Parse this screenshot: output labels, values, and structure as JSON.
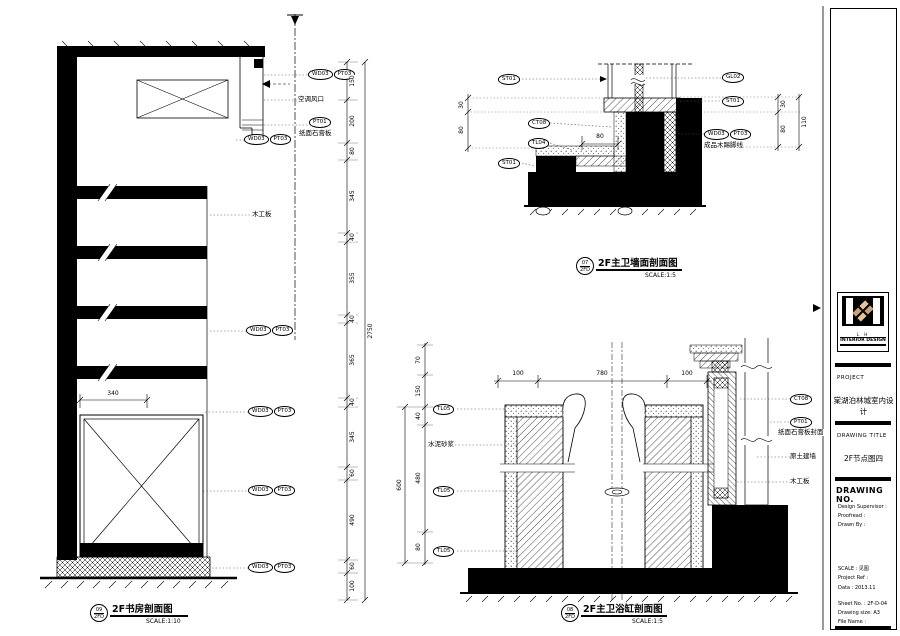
{
  "sheet": {
    "background": "#ffffff",
    "ink": "#000000",
    "wood_accent": "#c8a179",
    "wood_accent_light": "#e2c49e"
  },
  "codes": {
    "wd03": "WD03",
    "pt03": "PT03",
    "pt01": "PT01",
    "st01": "ST01",
    "gl02": "GL02",
    "ct08": "CT08",
    "tl04": "TL04",
    "tl05": "TL05"
  },
  "notes": {
    "ac_vent": "空调风口",
    "gypsum_board": "纸面石膏板",
    "wood_board": "木工板",
    "wood_skirting": "成品木踢脚线",
    "cement_mortar": "水泥砂浆",
    "gypsum_cover": "纸面石膏板封面",
    "original_wall": "原土建墙"
  },
  "drawings": {
    "study": {
      "bubble": {
        "no": "09",
        "sheet": "2FD"
      },
      "title": "2F书房剖面图",
      "scale": "SCALE:1:10",
      "dims": {
        "width": "340",
        "right": [
          "150",
          "200",
          "80",
          "345",
          "40",
          "355",
          "40",
          "365",
          "40",
          "345",
          "60",
          "490",
          "60",
          "100"
        ],
        "right_total": "2750"
      }
    },
    "wall": {
      "bubble": {
        "no": "07",
        "sheet": "2FD"
      },
      "title": "2F主卫墙面剖面图",
      "scale": "SCALE:1:5",
      "dims": {
        "width": "80",
        "left": [
          "30",
          "80"
        ],
        "right": [
          "30",
          "80"
        ],
        "right_total": "110"
      }
    },
    "tub": {
      "bubble": {
        "no": "08",
        "sheet": "2FD"
      },
      "title": "2F主卫浴缸剖面图",
      "scale": "SCALE:1:5",
      "dims": {
        "top": [
          "100",
          "780",
          "100"
        ],
        "left": [
          "70",
          "150",
          "40",
          "480",
          "80"
        ],
        "left_total": "600"
      }
    }
  },
  "title_block": {
    "logo": {
      "monogram": "L H",
      "brand": "INTERIOR DESIGN"
    },
    "project": {
      "label": "PROJECT",
      "value": "棠湖泊林城室内设计"
    },
    "drawing_title": {
      "label": "DRAWING TITLE",
      "value": "2F节点图四"
    },
    "drawing_no": {
      "label": "DRAWING NO."
    },
    "credits": [
      {
        "label": "Design Supervisor :",
        "value": ""
      },
      {
        "label": "Proofread :",
        "value": ""
      },
      {
        "label": "Drawn By :",
        "value": ""
      }
    ],
    "meta": [
      {
        "label": "SCALE",
        "value": ": 见图"
      },
      {
        "label": "Project Ref :",
        "value": ""
      },
      {
        "label": "Data",
        "value": ": 2013.11"
      }
    ],
    "sheet_info": [
      {
        "label": "Sheet No.",
        "value": ": 2F-D-04"
      },
      {
        "label": "Drawing size:",
        "value": "A3"
      },
      {
        "label": "File Name",
        "value": ":"
      }
    ]
  }
}
